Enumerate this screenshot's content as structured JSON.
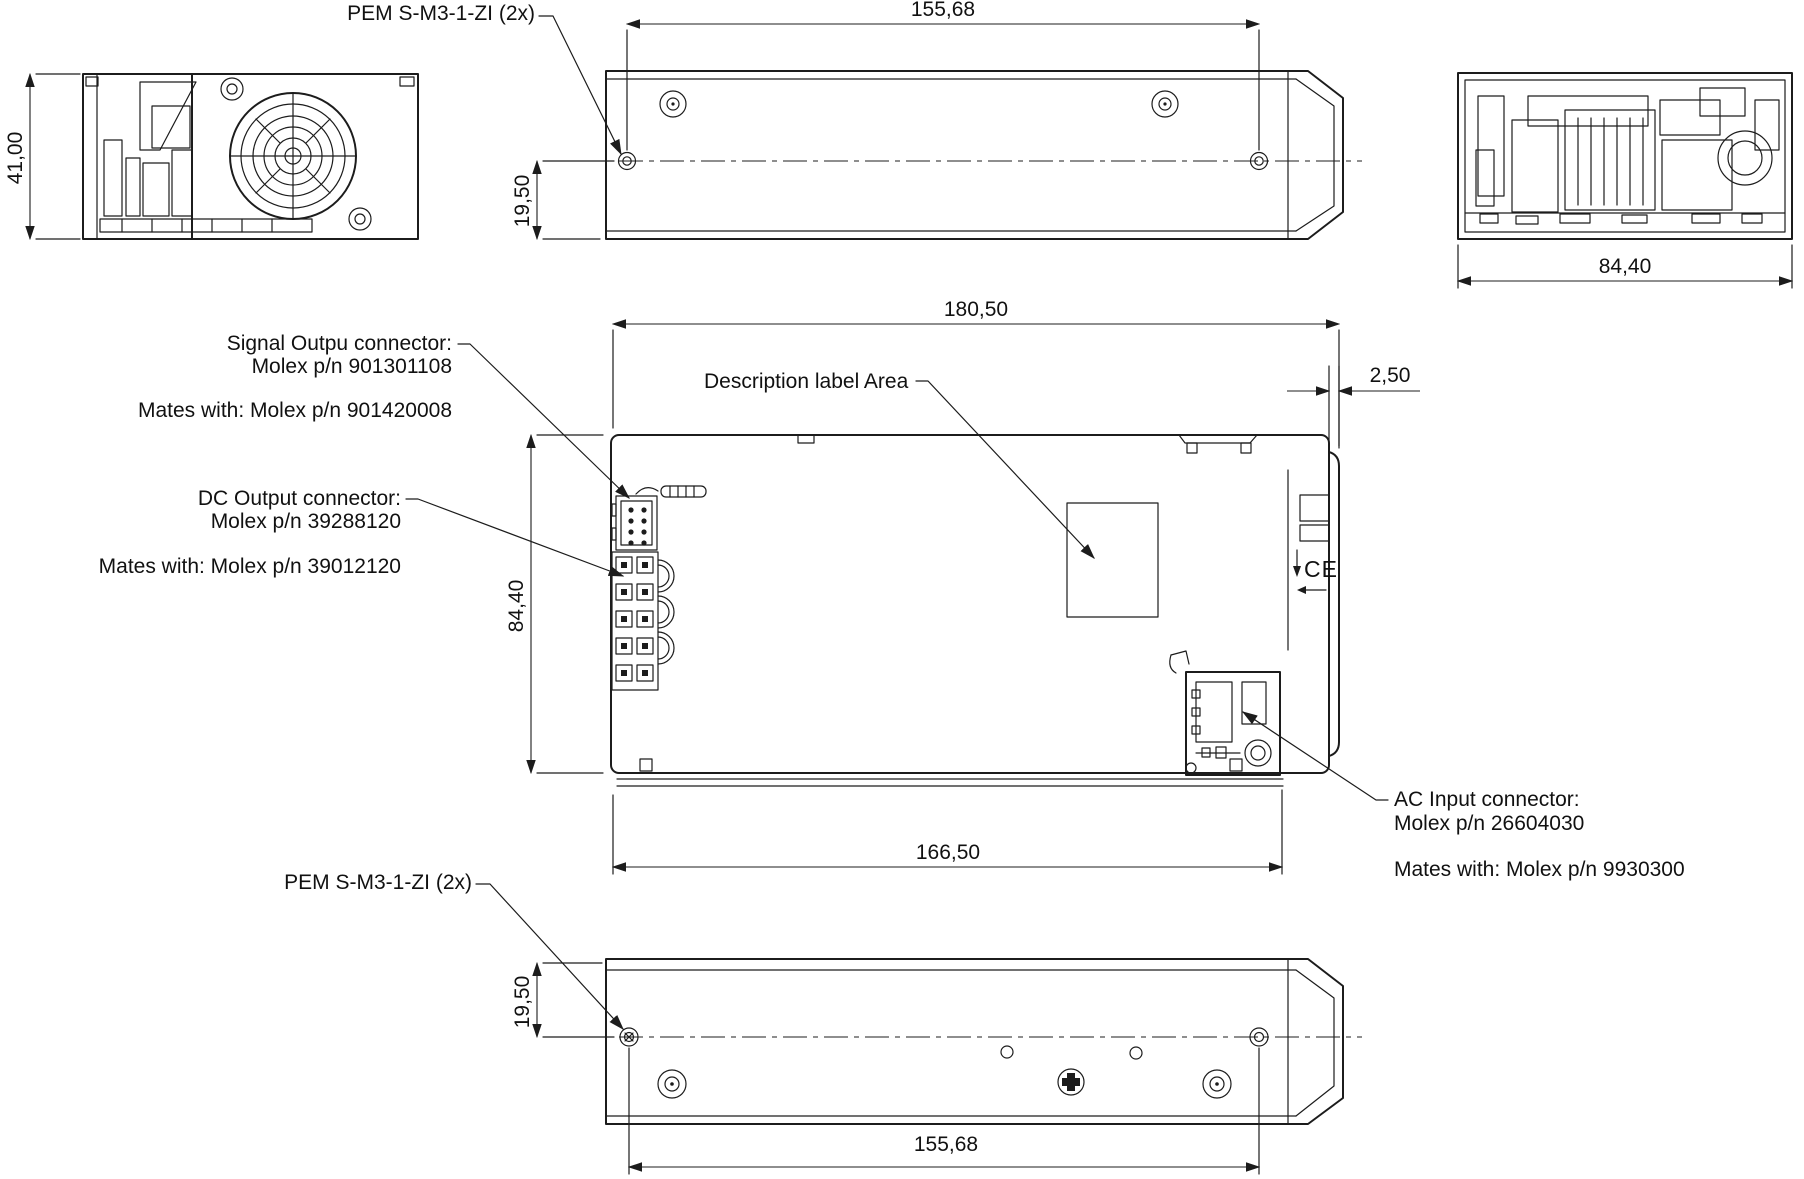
{
  "drawing": {
    "labels": {
      "pem_top": "PEM S-M3-1-ZI (2x)",
      "pem_bottom": "PEM S-M3-1-ZI (2x)",
      "signal_connector_line1": "Signal Outpu connector:",
      "signal_connector_line2": "Molex p/n 901301108",
      "signal_mates": "Mates with: Molex p/n 901420008",
      "dc_connector_line1": "DC Output connector:",
      "dc_connector_line2": "Molex p/n 39288120",
      "dc_mates": "Mates with: Molex p/n 39012120",
      "description_label": "Description label Area",
      "ac_connector_line1": "AC Input connector:",
      "ac_connector_line2": "Molex p/n 26604030",
      "ac_mates": "Mates with: Molex p/n 9930300",
      "ce_mark": "CE"
    },
    "dimensions": {
      "top_width": "155,68",
      "front_height": "41,00",
      "top_offset": "19,50",
      "back_width": "84,40",
      "overall_length": "180,50",
      "edge_offset": "2,50",
      "body_depth": "84,40",
      "bottom_length": "166,50",
      "bottom_offset": "19,50",
      "bottom_width": "155,68"
    },
    "colors": {
      "line": "#1c1c1c",
      "background": "#ffffff"
    }
  }
}
